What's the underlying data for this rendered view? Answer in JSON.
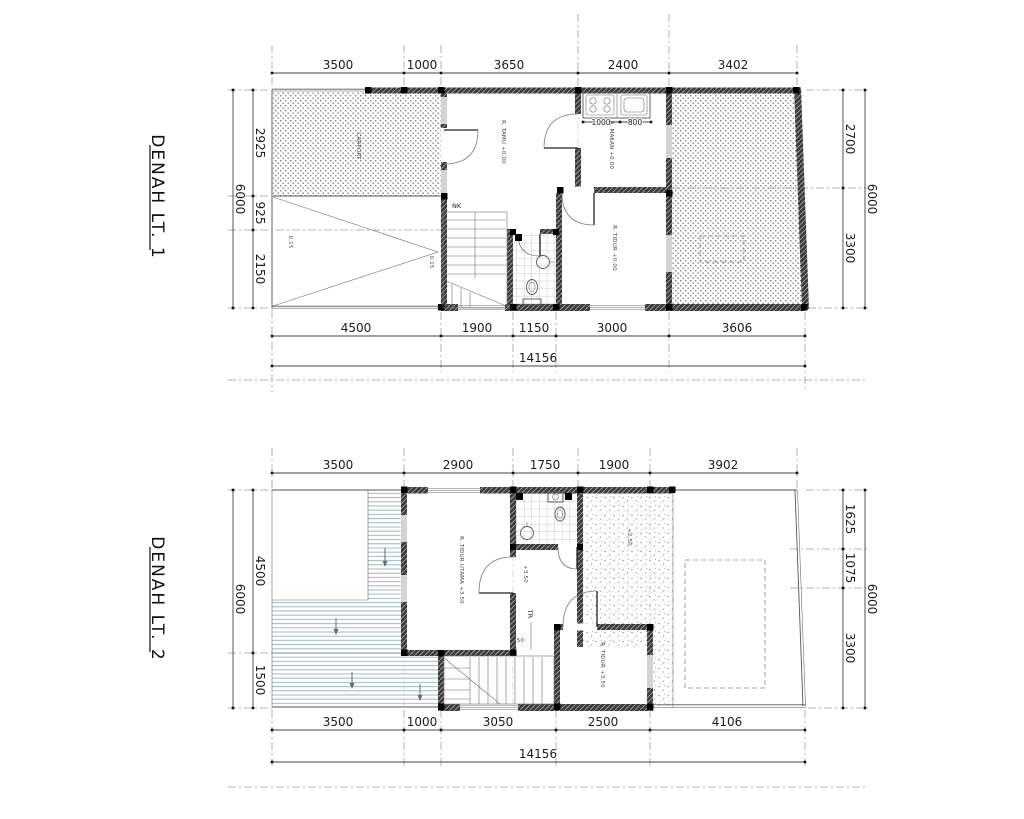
{
  "titles": {
    "lt1": "DENAH LT. 1",
    "lt2": "DENAH LT. 2"
  },
  "lt1": {
    "dims_top": [
      "3500",
      "1000",
      "3650",
      "2400",
      "3402"
    ],
    "dims_bottom": [
      "4500",
      "1900",
      "1150",
      "3000",
      "3606"
    ],
    "dims_left": [
      "2925",
      "925",
      "2150"
    ],
    "dims_right": [
      "2700",
      "3300"
    ],
    "total_width": "14156",
    "total_depth": "6000",
    "kitchen_dims": [
      "1000",
      "800"
    ],
    "labels": {
      "stair": "NK",
      "carport": "CARPORT",
      "living": "R. TAMU +0.00",
      "dining": "R. MAKAN +0.00",
      "bedroom": "R. TIDUR +0.00",
      "slope": "0.15"
    }
  },
  "lt2": {
    "dims_top": [
      "3500",
      "2900",
      "1750",
      "1900",
      "3902"
    ],
    "dims_bottom": [
      "3500",
      "1000",
      "3050",
      "2500",
      "4106"
    ],
    "dims_left": [
      "4500",
      "1500"
    ],
    "dims_right": [
      "1625",
      "1075",
      "3300"
    ],
    "total_width": "14156",
    "total_depth": "6000",
    "labels": {
      "stair": "TR",
      "step": "150",
      "master": "R. TIDUR UTAMA +3.50",
      "bedroom": "R. TIDUR +3.50",
      "hall": "+3.50",
      "terrace": "+2.50"
    }
  }
}
